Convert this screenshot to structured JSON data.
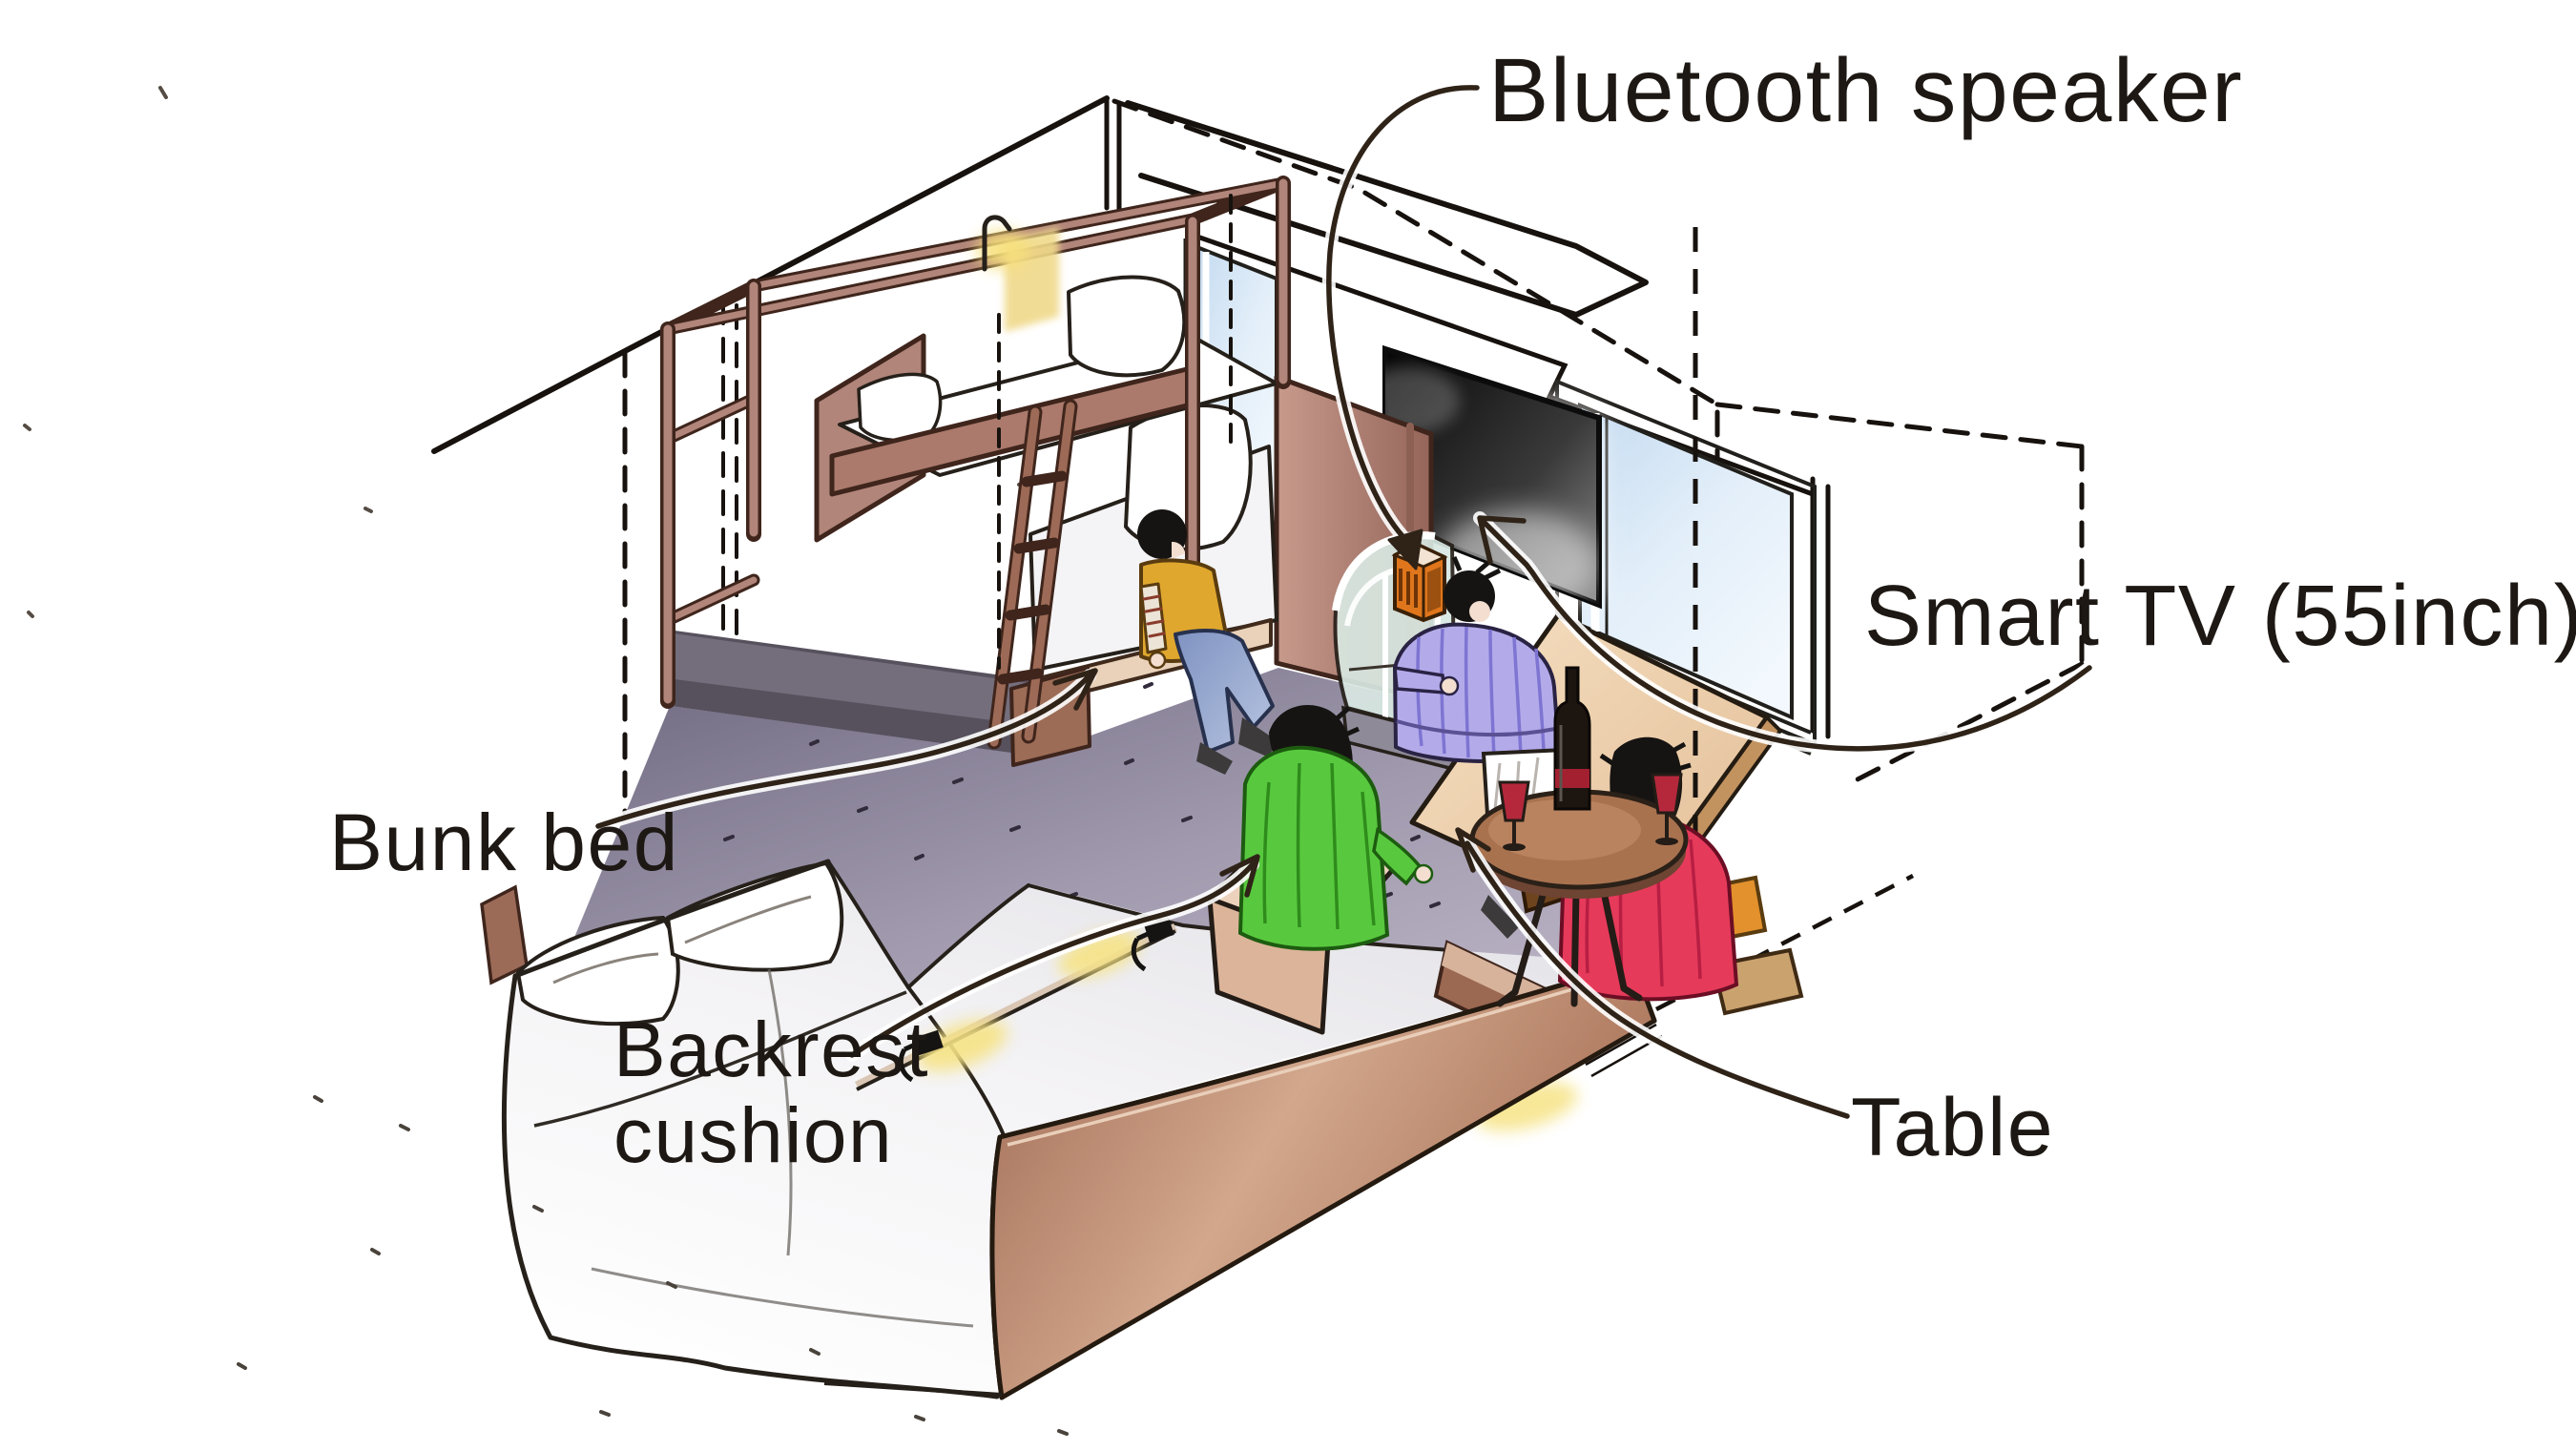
{
  "scene": {
    "type": "isometric cutaway sketch of a hotel guest room",
    "objects": [
      "bunk bed with ladder and reading lamp",
      "wall-mounted smart tv",
      "window with blue glass",
      "curved glass bar with bluetooth speaker",
      "round wine table with bottle and glasses",
      "two double beds with backrest cushions and reading lights",
      "wooden footboard panel",
      "four people (yellow vest, purple striped shirt, green shirt, red shirt)"
    ],
    "people_count": "4"
  },
  "annotations": {
    "bluetooth_speaker": "Bluetooth speaker",
    "smart_tv": "Smart TV (55inch)",
    "bunk_bed": "Bunk bed",
    "backrest_cushion_line1": "Backrest",
    "backrest_cushion_line2": "cushion",
    "table": "Table"
  },
  "colors": {
    "label_text": "#1d1813",
    "leader_line": "#2f2318",
    "wood_frame": "#b1857a",
    "footboard": "#b5806a",
    "carpet": "#9a93a6",
    "window_glass": "#cfe2f2",
    "tv_screen": "#1a1a1a",
    "speaker": "#e0761c",
    "shirt_green": "#58c93e",
    "shirt_red": "#e63a5b",
    "shirt_purple": "#b3abe9",
    "vest_yellow": "#dfa72e",
    "cushion_tan": "#dcb49a",
    "lamp_glow": "#f6e385"
  }
}
